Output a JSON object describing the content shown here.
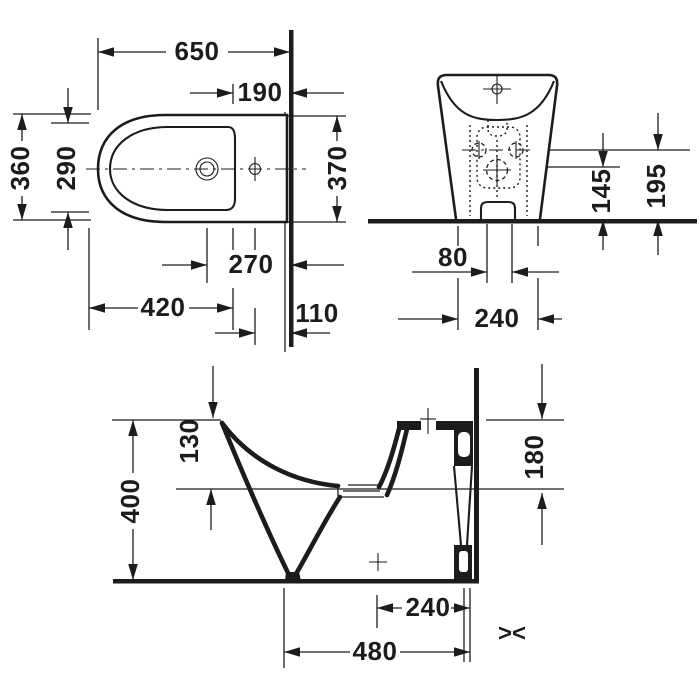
{
  "drawing": {
    "kind": "bidet installation technical drawing",
    "colors": {
      "line": "#1c1c1c",
      "background": "#ffffff"
    },
    "views": {
      "plan": {
        "length": "650",
        "rim_to_wall": "190",
        "width_front": "360",
        "bowl_width": "290",
        "width_back": "370",
        "drain_to_wall": "270",
        "front_to_drain": "420",
        "hole_to_wall": "110"
      },
      "front": {
        "outlet_height": "145",
        "holes_height": "195",
        "holes_span": "80",
        "base_width": "240"
      },
      "side": {
        "rim_depth": "130",
        "height": "400",
        "back_height": "180",
        "outlet_to_wall": "240",
        "depth": "480",
        "fit_symbol": "><"
      }
    }
  }
}
